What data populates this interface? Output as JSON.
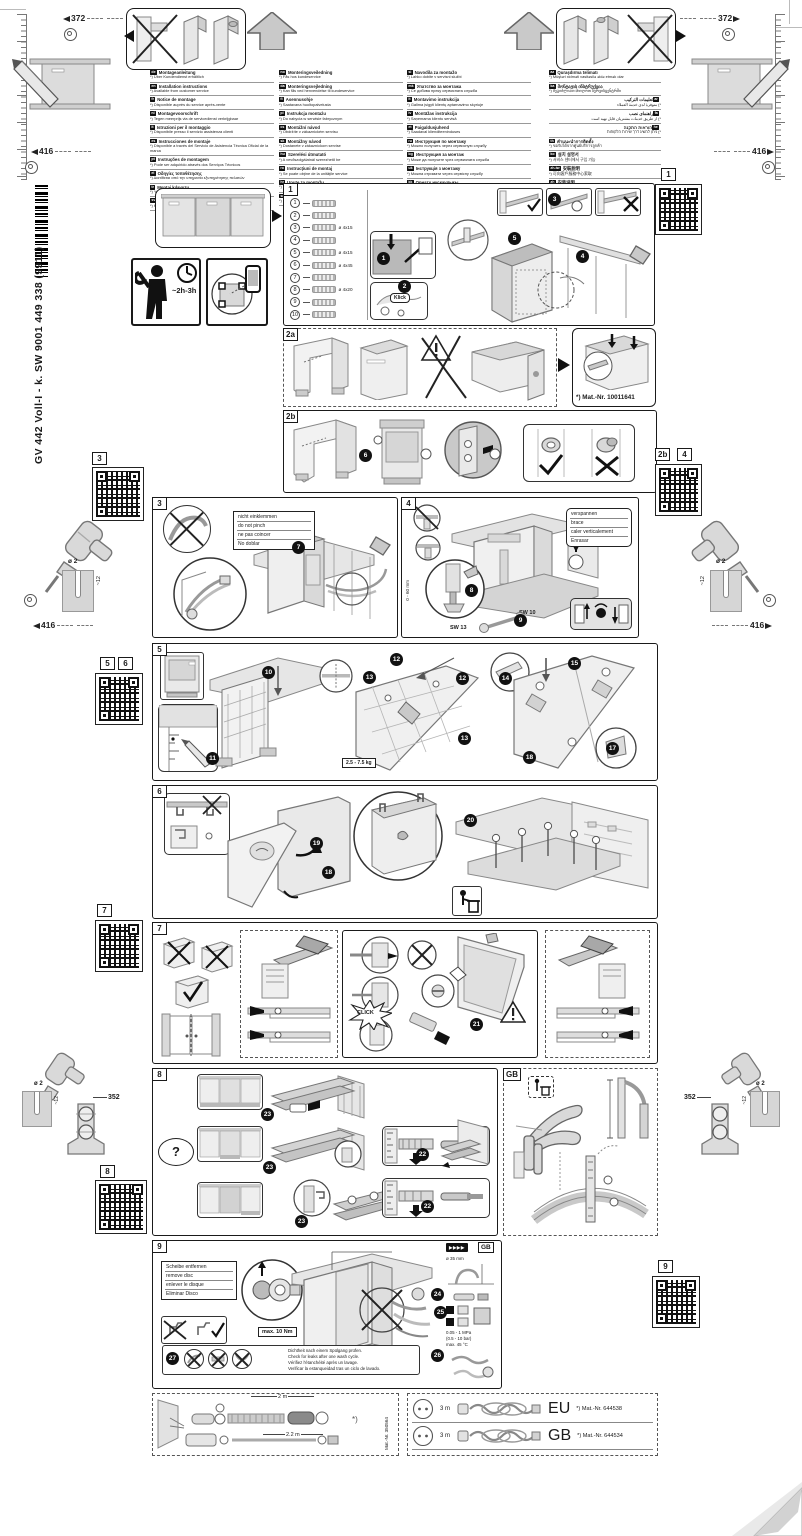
{
  "header": {
    "dim_left": "372",
    "dim_right": "372",
    "height_left": "416",
    "height_right": "416"
  },
  "sidebar": {
    "code_vertical": "GV 442 Voll-I - k. SW  9001 449 338 (9911)"
  },
  "prep": {
    "time": "~2h-3h"
  },
  "margin": {
    "drill_dia": "ø 2",
    "drill_depth": "~12",
    "dim_416": "416",
    "dim_352": "352"
  },
  "qr_labels": {
    "r1": "1",
    "l3": "3",
    "l5": "5",
    "l6": "6",
    "r2b": "2b",
    "r4": "4",
    "l7": "7",
    "l8": "8",
    "r9": "9"
  },
  "languages": {
    "col1": [
      {
        "code": "de",
        "title": "Montageanleitung",
        "note": "*) Über Kundendienst erhältlich"
      },
      {
        "code": "en",
        "title": "Installation instructions",
        "note": "*) Available from customer service"
      },
      {
        "code": "fr",
        "title": "Notice de montage",
        "note": "*) Disponible auprès du service après-vente"
      },
      {
        "code": "nl",
        "title": "Montagevoorschrift",
        "note": "*) Tegen meerprijs via de servicedienst verkrijgbaar"
      },
      {
        "code": "it",
        "title": "Istruzioni per il montaggio",
        "note": "*) Disponibile presso il servizio assistenza clienti"
      },
      {
        "code": "es",
        "title": "Instrucciones de montaje",
        "note": "*) Disponible a través del Servicio de Asistencia Técnica Oficial de la marca"
      },
      {
        "code": "pt",
        "title": "Instruções de montagem",
        "note": "*) Pode ser adquirido através dos Serviços Técnicos"
      },
      {
        "code": "el",
        "title": "Οδηγίες τοποθέτησης",
        "note": "*) Διατίθεται από την υπηρεσία εξυπηρέτησης πελατών"
      },
      {
        "code": "tr",
        "title": "Montaj kılavuzu",
        "note": "*) Yetkili servisten temin edilebilir"
      },
      {
        "code": "sv",
        "title": "Monteringsanvisning",
        "note": "*) Kan fås via service"
      }
    ],
    "col2": [
      {
        "code": "no",
        "title": "Monteringsveiledning",
        "note": "*) Fås hos kundeservice"
      },
      {
        "code": "da",
        "title": "Monteringsvejledning",
        "note": "*) Kan fås ved henvendelse til kundeservice"
      },
      {
        "code": "fi",
        "title": "Asennusohje",
        "note": "*) Saatavana huoltopalvelusta"
      },
      {
        "code": "pl",
        "title": "Instrukcja montażu",
        "note": "*) Do nabycia w serwisie fabrycznym"
      },
      {
        "code": "cs",
        "title": "Montážní návod",
        "note": "*) Obdržíte v zákaznickém servisu"
      },
      {
        "code": "sk",
        "title": "Montážny návod",
        "note": "*) Dostanete v zákazníckom servise"
      },
      {
        "code": "hu",
        "title": "Szerelési útmutató",
        "note": "*) A vevőszolgálatnál szerezhető be"
      },
      {
        "code": "ro",
        "title": "Instrucţiuni de montaj",
        "note": "*) Se poate obţine de la unităţile service"
      },
      {
        "code": "hr",
        "title": "Upute za montažu",
        "note": "*) Mogu se dobiti kod servisne službe"
      },
      {
        "code": "sr",
        "title": "Uputstvo za montažu",
        "note": "*) Može da se nabavi preko servisne službe"
      }
    ],
    "col3": [
      {
        "code": "sl",
        "title": "Navodila za montažo",
        "note": "*) Lahko dobite v servisni službi"
      },
      {
        "code": "mk",
        "title": "Упатство за монтажа",
        "note": "*) Се добива преку сервисната служба"
      },
      {
        "code": "lt",
        "title": "Montavimo instrukcija",
        "note": "*) Galima įsigyti klientų aptarnavimo skyriuje"
      },
      {
        "code": "lv",
        "title": "Montāžas instrukcija",
        "note": "*) Saņemama klientu servisā"
      },
      {
        "code": "et",
        "title": "Paigaldusjuhend",
        "note": "*) Saadaval klienditeeninduses"
      },
      {
        "code": "ru",
        "title": "Инструкция по монтажу",
        "note": "*) Можно получить через сервисную службу"
      },
      {
        "code": "bg",
        "title": "Инструкция за монтаж",
        "note": "*) Може да получите чрез сервизната служба"
      },
      {
        "code": "uk",
        "title": "Інструкція з монтажу",
        "note": "*) Можна отримати через сервісну службу"
      },
      {
        "code": "kk",
        "title": "Орнату нұсқаулығы",
        "note": "*) Сервистік қызмет арқылы алуға болады"
      }
    ],
    "col4": [
      {
        "code": "az",
        "title": "Quraşdırma təlimatı",
        "note": "*) Müştəri xidməti vasitəsilə əldə etmək olar"
      },
      {
        "code": "ka",
        "title": "მონტაჟის ინსტრუქცია",
        "note": "*) შეგიძლიათ მიიღოთ სერვისცენტრში"
      },
      {
        "code": "ar",
        "title": "تعليمات التركيب",
        "note": "*) متوفرة لدى خدمة العملاء"
      },
      {
        "code": "fa",
        "title": "راهنمای نصب",
        "note": "*) از طریق خدمات مشتریان قابل تهیه است"
      },
      {
        "code": "he",
        "title": "הוראות התקנה",
        "note": "*) ניתן להשיג דרך שירות הלקוחות"
      },
      {
        "code": "th",
        "title": "คำแนะนำการติดตั้ง",
        "note": "*) ขอรับได้จากศูนย์บริการลูกค้า"
      },
      {
        "code": "ko",
        "title": "설치 설명서",
        "note": "*) 서비스 센터에서 구입 가능"
      },
      {
        "code": "zh-tw",
        "title": "安裝說明",
        "note": "*) 可向客戶服務中心索取"
      },
      {
        "code": "zh",
        "title": "安装说明",
        "note": "*) 可通过客户服务获取"
      }
    ]
  },
  "s1": {
    "label": "1",
    "klick": "Klick",
    "steps": [
      "1",
      "2",
      "3",
      "4",
      "5"
    ],
    "parts": [
      {
        "n": "1",
        "size": ""
      },
      {
        "n": "2",
        "size": ""
      },
      {
        "n": "3",
        "size": "ø 4x15"
      },
      {
        "n": "4",
        "size": ""
      },
      {
        "n": "5",
        "size": "ø 4x15"
      },
      {
        "n": "6",
        "size": "ø 4x45"
      },
      {
        "n": "7",
        "size": ""
      },
      {
        "n": "8",
        "size": "ø 4x20"
      },
      {
        "n": "9",
        "size": ""
      },
      {
        "n": "10",
        "size": ""
      }
    ]
  },
  "s2a": {
    "label": "2a",
    "mat_nr": "*) Mat.-Nr. 10011641"
  },
  "s2b": {
    "label": "2b",
    "step": "6"
  },
  "s3": {
    "label": "3",
    "step": "7",
    "note": [
      "nicht einklemmen",
      "do not pinch",
      "ne pas coincer",
      "No doblar"
    ]
  },
  "s4": {
    "label": "4",
    "steps": [
      "8",
      "9"
    ],
    "note": [
      "verspannen",
      "brace",
      "caler verticalement",
      "Enrasar"
    ],
    "sw13": "SW 13",
    "sw10": "SW 10",
    "range": "0 - 60 mm"
  },
  "s5": {
    "label": "5",
    "weight": "2.5 - 7.5 kg",
    "steps": [
      "10",
      "11",
      "12",
      "13",
      "12",
      "13",
      "14",
      "15",
      "18",
      "17"
    ]
  },
  "s6": {
    "label": "6",
    "steps": [
      "19",
      "18",
      "20"
    ]
  },
  "s7": {
    "label": "7",
    "step": "21",
    "click": "CLICK"
  },
  "s8": {
    "label": "8",
    "question": "?",
    "steps": [
      "23",
      "23",
      "23",
      "22",
      "22"
    ]
  },
  "gb": {
    "label": "GB"
  },
  "s9": {
    "label": "9",
    "gb": "GB",
    "ff": "▶▶▶▶",
    "remove_disc": [
      "Scheibe entfernen",
      "remove disc",
      "enlever le disque",
      "Eliminar Disco"
    ],
    "torque": "max. 10 Nm",
    "hole": "ø 35 mm",
    "pressure": [
      "0.05 - 1 MPa",
      "(0.5 - 10 bar)",
      "max. 45 °C"
    ],
    "check": [
      "Dichtheit nach einem Spülgang prüfen.",
      "Check for leaks after one wash cycle.",
      "Vérifiez l'étanchéité après un lavage.",
      "Verificar la estanqueidad tras un ciclo de lavado."
    ],
    "steps": [
      "24",
      "25",
      "26",
      "27"
    ]
  },
  "bottom_left": {
    "len_top": "2 m",
    "len_bottom": "2.2 m",
    "mat_nr": "Mat.-Nr. 350564"
  },
  "bottom_right": {
    "rows": [
      {
        "len": "3 m",
        "region": "EU",
        "mat": "*) Mat.-Nr. 644538"
      },
      {
        "len": "3 m",
        "region": "GB",
        "mat": "*) Mat.-Nr. 644534"
      }
    ]
  }
}
